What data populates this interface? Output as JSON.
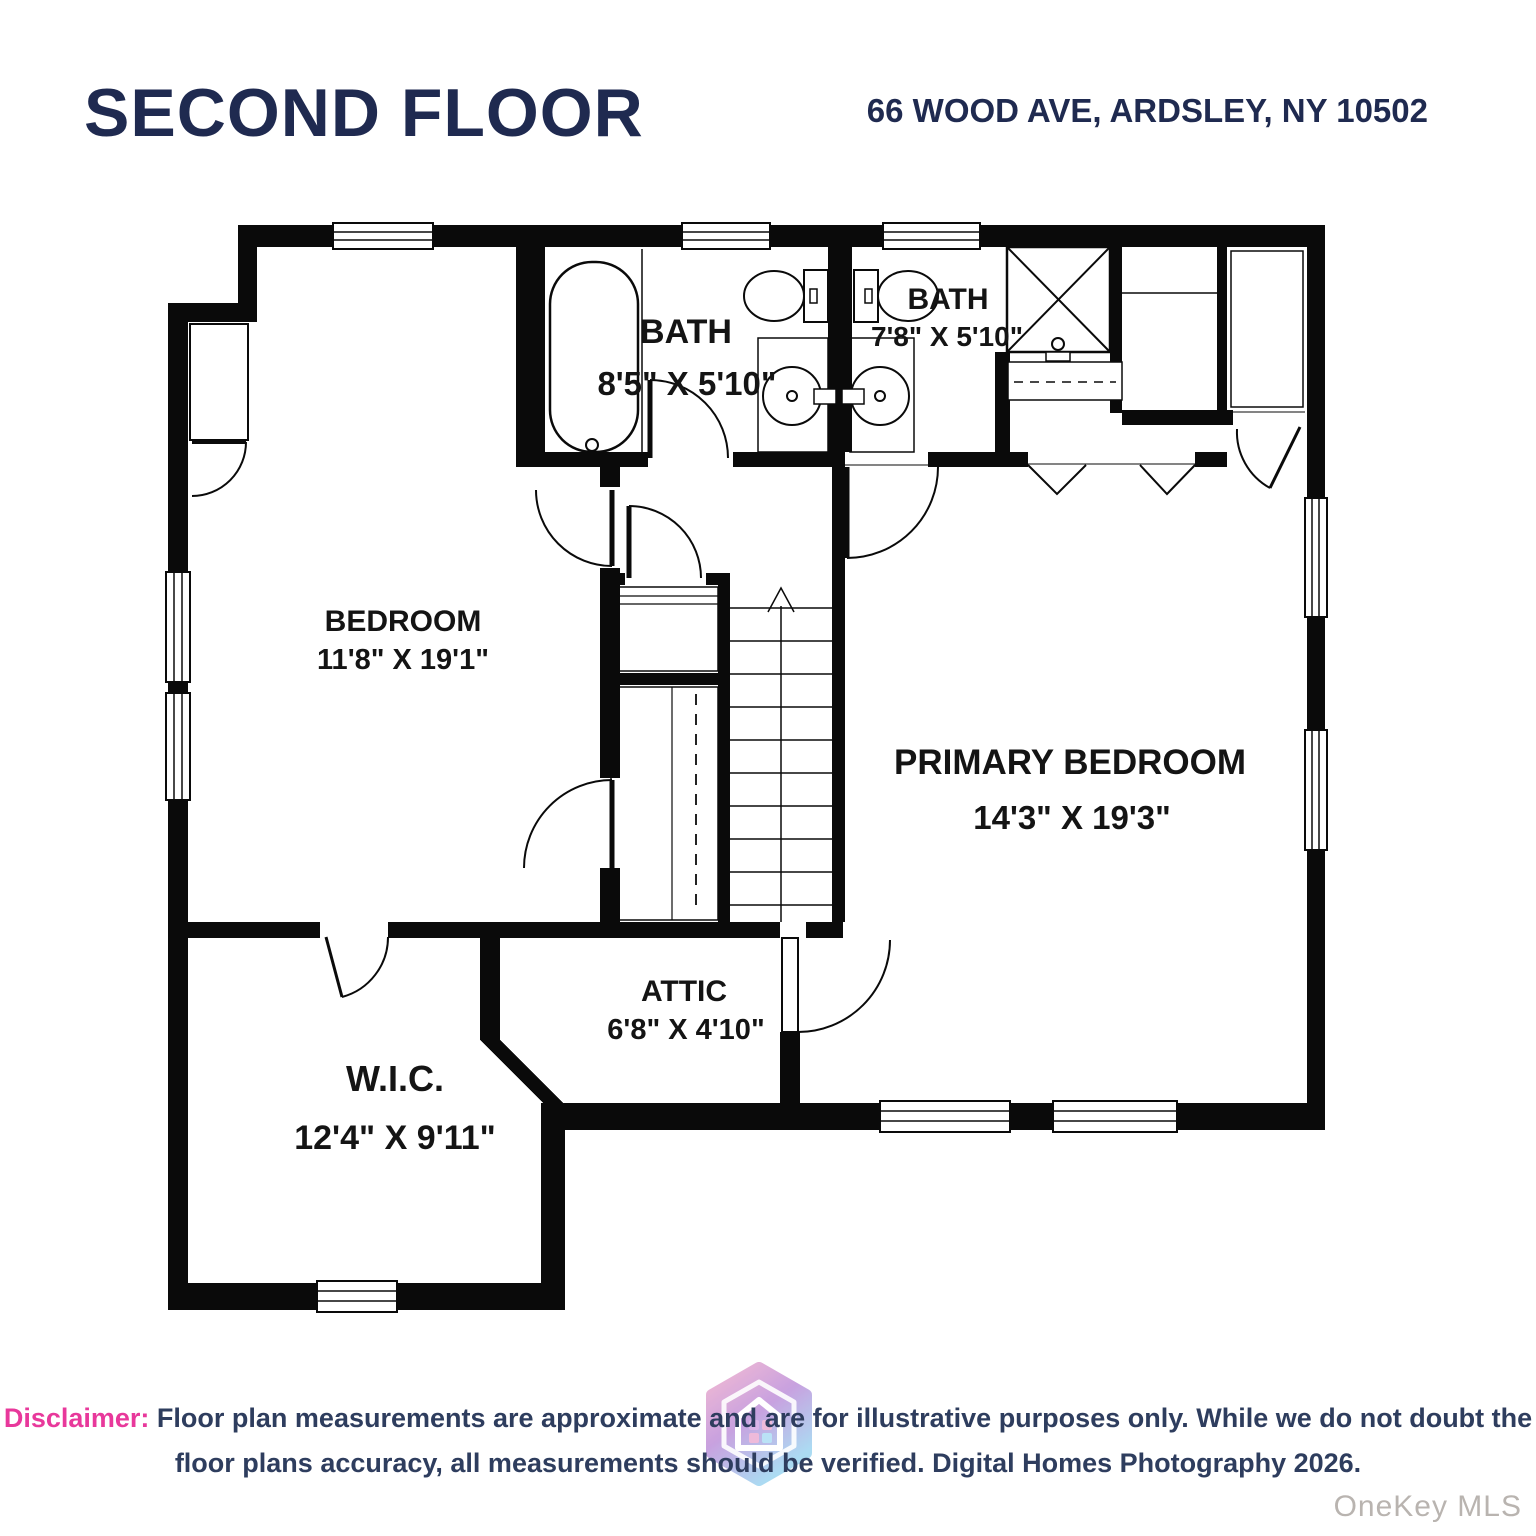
{
  "header": {
    "title": "SECOND FLOOR",
    "address": "66 WOOD AVE, ARDSLEY, NY 10502"
  },
  "rooms": {
    "bath1": {
      "name": "BATH",
      "dims": "8'5\" X 5'10\""
    },
    "bath2": {
      "name": "BATH",
      "dims": "7'8\" X 5'10\""
    },
    "bedroom": {
      "name": "BEDROOM",
      "dims": "11'8\" X 19'1\""
    },
    "primary": {
      "name": "PRIMARY BEDROOM",
      "dims": "14'3\" X 19'3\""
    },
    "attic": {
      "name": "ATTIC",
      "dims": "6'8\" X 4'10\""
    },
    "wic": {
      "name": "W.I.C.",
      "dims": "12'4\" X 9'11\""
    }
  },
  "stairs": {
    "direction": "up"
  },
  "footer": {
    "disclaimer_label": "Disclaimer:",
    "disclaimer_line1": "Floor plan measurements are approximate and are for illustrative purposes only. While we do not doubt the",
    "disclaimer_line2": "floor plans accuracy, all measurements should be verified. Digital Homes Photography 2026.",
    "watermark": "OneKey MLS"
  },
  "colors": {
    "wall": "#0a0a0a",
    "heading_navy": "#1f2a50",
    "disclaimer_navy": "#2e3d5e",
    "disclaimer_pink": "#e8389b",
    "watermark_gray": "#b9b4b0",
    "logo_pink": "#efa9c9",
    "logo_purple": "#bb8ad8",
    "logo_blue": "#97d3f0"
  }
}
